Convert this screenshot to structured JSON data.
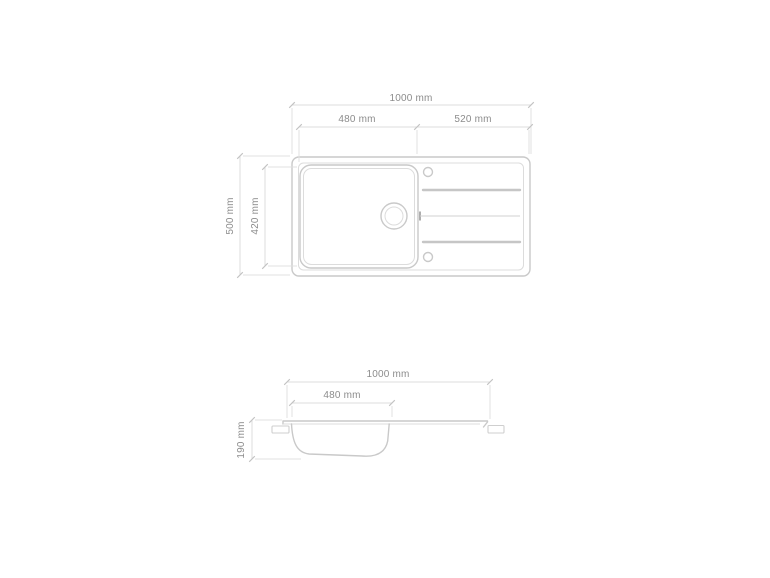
{
  "drawing": {
    "kind": "technical-dimension-drawing",
    "subject": "kitchen sink with left basin and right drainboard",
    "colors": {
      "background": "#ffffff",
      "outline": "#c9c9c9",
      "dimension_line": "#dcdcdc",
      "label_text": "#8c8c8c"
    },
    "top_view": {
      "total_width": "1000 mm",
      "basin_width": "480 mm",
      "drainer_width": "520 mm",
      "total_depth": "500 mm",
      "basin_depth": "420 mm"
    },
    "side_view": {
      "total_width": "1000 mm",
      "basin_width": "480 mm",
      "basin_height": "190 mm"
    }
  }
}
